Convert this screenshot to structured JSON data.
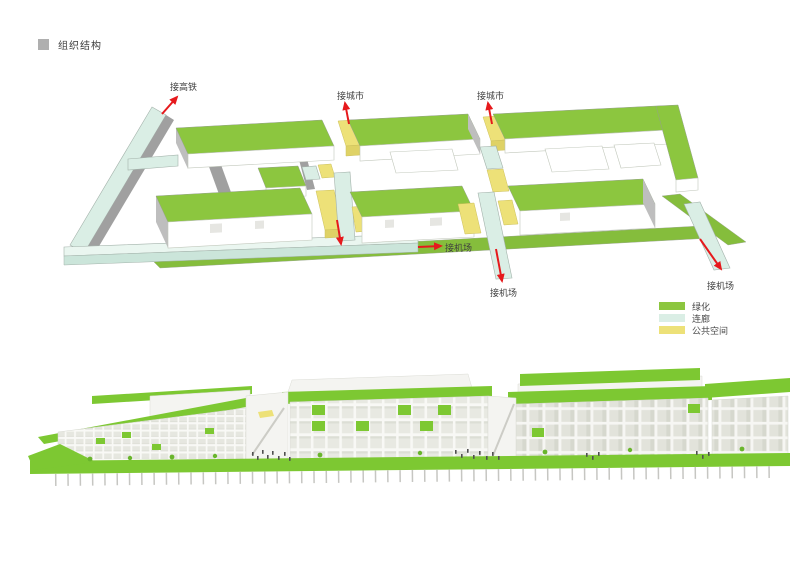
{
  "title": {
    "label": "组织结构"
  },
  "axon": {
    "labels": {
      "rail": "接高铁",
      "city_left": "接城市",
      "city_right": "接城市",
      "airport_left": "接机场",
      "airport_center": "接机场",
      "airport_right": "接机场"
    },
    "legend": [
      {
        "label": "绿化",
        "swatch": "green"
      },
      {
        "label": "连廊",
        "swatch": "corridor"
      },
      {
        "label": "公共空间",
        "swatch": "yellow"
      }
    ]
  },
  "colors": {
    "green": "#8CC63F",
    "green_ground": "#85BD3C",
    "green_bright": "#7DC832",
    "green_dark": "#69B52C",
    "corridor": "#DAEEE5",
    "corridor_light": "#EAF6F0",
    "corridor_dark": "#CBE5DA",
    "yellow": "#EDE178",
    "yellow_dark": "#DFD266",
    "red": "#E6191C",
    "gray_wall": "#A0A0A0",
    "gray_gable": "#BEBEBE",
    "text": "#3F3F3F",
    "title_square": "#AFAFAF"
  }
}
